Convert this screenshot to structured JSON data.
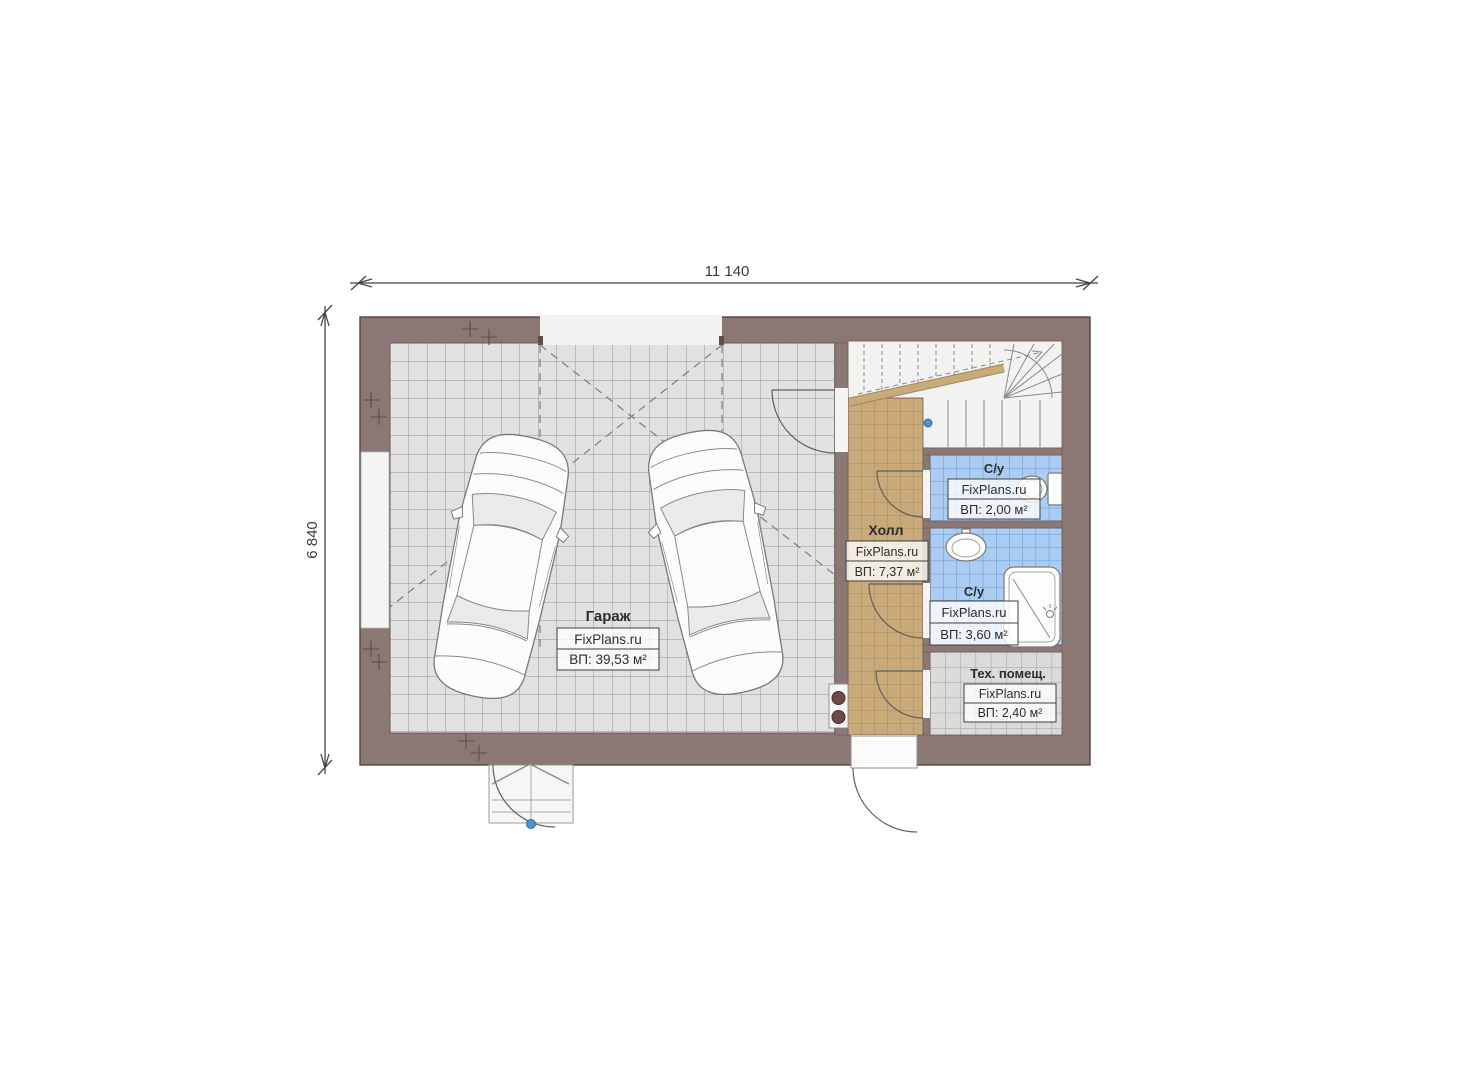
{
  "plan": {
    "dim_top": "11 140",
    "dim_left": "6 840",
    "rooms": {
      "garage": {
        "name": "Гараж",
        "brand": "FixPlans.ru",
        "area": "ВП: 39,53 м²"
      },
      "hall": {
        "name": "Холл",
        "brand": "FixPlans.ru",
        "area": "ВП: 7,37 м²"
      },
      "wc_small": {
        "name": "С/у",
        "brand": "FixPlans.ru",
        "area": "ВП: 2,00 м²"
      },
      "wc_large": {
        "name": "С/у",
        "brand": "FixPlans.ru",
        "area": "ВП: 3,60 м²"
      },
      "tech": {
        "name": "Тех. помещ.",
        "brand": "FixPlans.ru",
        "area": "ВП: 2,40 м²"
      }
    },
    "colors": {
      "wall": "#8b7773",
      "garage_tile": "#e0e1e0",
      "hall_tile": "#c9aa7b",
      "wet_tile": "#accdf3",
      "tech_tile": "#dbdbd9",
      "stairs_floor": "#f2f2f0",
      "marker_dot": "#4e94cb"
    }
  }
}
